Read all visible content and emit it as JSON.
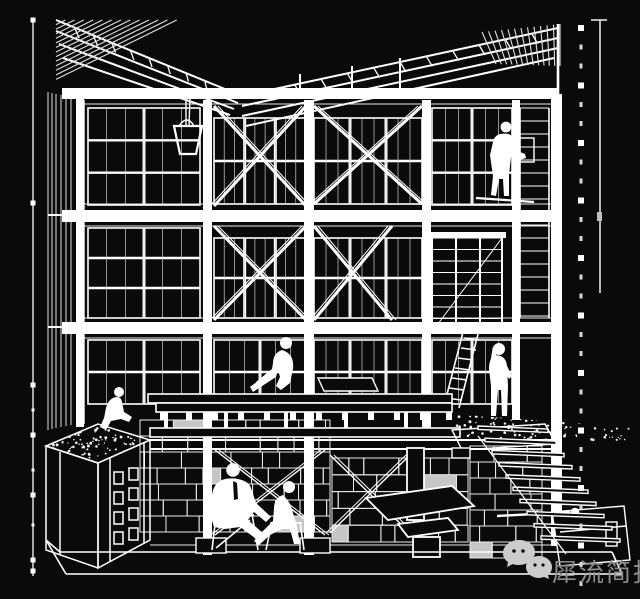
{
  "canvas": {
    "width": 640,
    "height": 599,
    "background": "#0a0a0a",
    "line_color": "#ffffff",
    "dim_color": "#c9c9c9"
  },
  "watermark": {
    "text": "犀流简报",
    "text_color": "#8f8f8f",
    "icon": "wechat-icon",
    "icon_color": "#cccccc",
    "icon_eye_color": "#0a0a0a"
  },
  "scene": {
    "description": "white wireframe cutaway section of a three-storey timber-framed building",
    "figures": [
      "worker-on-upper-scaffold",
      "person-sitting-on-platform-edge",
      "person-standing-by-stair",
      "person-crouching-on-planter",
      "seated-person-left-basement",
      "seated-person-right-basement"
    ]
  },
  "geometry": {
    "rulers": {
      "left": {
        "x": 33,
        "y1": 20,
        "y2": 576,
        "big": [
          20,
          203,
          385,
          435,
          495,
          560,
          571
        ],
        "small": [
          410,
          470,
          525
        ]
      },
      "right_dashed": {
        "x": 581,
        "y_start": 28,
        "step": 57.5,
        "count": 10,
        "small_offsets": [
          19,
          38
        ]
      },
      "right_solid": {
        "x": 600,
        "y1": 20,
        "y2": 293,
        "cap_x1": 591,
        "cap_x2": 607,
        "tick_y": 212
      }
    },
    "beams": [
      [
        62,
        88,
        496,
        11
      ],
      [
        62,
        210,
        496,
        12
      ],
      [
        62,
        322,
        496,
        12
      ]
    ],
    "columns": [
      [
        76,
        95,
        8,
        332
      ],
      [
        203,
        100,
        9,
        455
      ],
      [
        304,
        100,
        10,
        455
      ],
      [
        422,
        100,
        9,
        330
      ],
      [
        512,
        100,
        8,
        320
      ],
      [
        551,
        94,
        11,
        452
      ]
    ],
    "guide_lines": [
      [
        84,
        104,
        556,
        104
      ],
      [
        84,
        204,
        556,
        204
      ],
      [
        84,
        226,
        556,
        226
      ],
      [
        84,
        318,
        556,
        318
      ],
      [
        84,
        338,
        556,
        338
      ],
      [
        150,
        545,
        560,
        545
      ]
    ],
    "windows": [
      [
        88,
        108,
        112,
        97,
        2,
        3
      ],
      [
        214,
        118,
        92,
        86,
        3,
        2
      ],
      [
        314,
        118,
        108,
        86,
        3,
        2
      ],
      [
        432,
        108,
        80,
        97,
        2,
        3
      ],
      [
        88,
        228,
        112,
        90,
        2,
        3
      ],
      [
        214,
        238,
        92,
        80,
        3,
        2
      ],
      [
        314,
        238,
        108,
        80,
        3,
        2
      ],
      [
        88,
        340,
        112,
        64,
        2,
        2
      ],
      [
        214,
        340,
        92,
        64,
        2,
        2
      ],
      [
        314,
        340,
        108,
        64,
        3,
        2
      ],
      [
        432,
        340,
        80,
        64,
        2,
        2
      ]
    ],
    "braces": [
      [
        214,
        106,
        92,
        100
      ],
      [
        314,
        106,
        108,
        98
      ],
      [
        214,
        226,
        92,
        94
      ],
      [
        314,
        226,
        78,
        94
      ]
    ],
    "basement_braces": [
      [
        215,
        450,
        110,
        85
      ],
      [
        330,
        455,
        80,
        78
      ]
    ],
    "stairs": {
      "count": 10,
      "x1": 478,
      "x2": 548,
      "dx1": 7,
      "dx2": 8,
      "y0": 426,
      "dy": 12.2,
      "drop": 3,
      "max_x": 622
    },
    "masonry": [
      {
        "x": 140,
        "y": 420,
        "w": 190,
        "h": 112,
        "rows": 7,
        "seed": 7,
        "fill_chance": 0.06
      },
      {
        "x": 332,
        "y": 458,
        "w": 136,
        "h": 84,
        "rows": 5,
        "seed": 11,
        "fill_chance": 0.08
      },
      {
        "x": 470,
        "y": 446,
        "w": 72,
        "h": 112,
        "rows": 7,
        "seed": 3,
        "fill_chance": 0.1
      }
    ],
    "stipples": [
      {
        "x": 56,
        "y": 428,
        "w": 86,
        "h": 30,
        "shear": -14,
        "n": 110,
        "seed": 5
      },
      {
        "x": 450,
        "y": 416,
        "w": 190,
        "h": 24,
        "shear": 8,
        "n": 120,
        "seed": 9
      }
    ],
    "scaffold": {
      "xs": [
        432,
        456,
        480,
        502
      ],
      "y1": 238,
      "y2": 332,
      "step": 11.5
    },
    "rack": {
      "x1": 520,
      "x2": 549,
      "y1": 108,
      "y2": 318,
      "step": 13
    },
    "left_wall": {
      "xs": [
        48,
        52,
        56,
        61,
        66,
        71,
        77,
        83
      ],
      "y1": 92,
      "y2": 430,
      "floors": [
        215,
        327
      ]
    },
    "roof": {
      "left_rafters": [
        [
          56,
          20,
          242,
          96
        ],
        [
          56,
          31,
          238,
          103
        ],
        [
          59,
          44,
          234,
          109
        ],
        [
          63,
          58,
          230,
          115
        ]
      ],
      "right_rafters": [
        [
          242,
          96,
          558,
          28
        ],
        [
          242,
          106,
          558,
          38
        ],
        [
          242,
          116,
          558,
          48
        ],
        [
          246,
          126,
          554,
          58
        ]
      ],
      "apex": {
        "x": 558,
        "y1": 24,
        "y2": 95
      },
      "hangers": [
        [
          300,
          74
        ],
        [
          352,
          66
        ],
        [
          400,
          58
        ]
      ],
      "left_hatch": {
        "x": 56,
        "y": 20,
        "w": 130,
        "drop": 64,
        "n": 14
      },
      "right_hatch": {
        "top": [
          [
            482,
            32
          ],
          [
            560,
            24
          ]
        ],
        "bot": [
          [
            496,
            64
          ],
          [
            560,
            66
          ]
        ],
        "n": 12
      },
      "purlins": 11
    },
    "joists": {
      "x0": 160,
      "step": 26,
      "count": 12,
      "y": 410,
      "h": 10
    },
    "planks": {
      "x": 148,
      "y": 394,
      "w": 304,
      "count": 8
    }
  }
}
